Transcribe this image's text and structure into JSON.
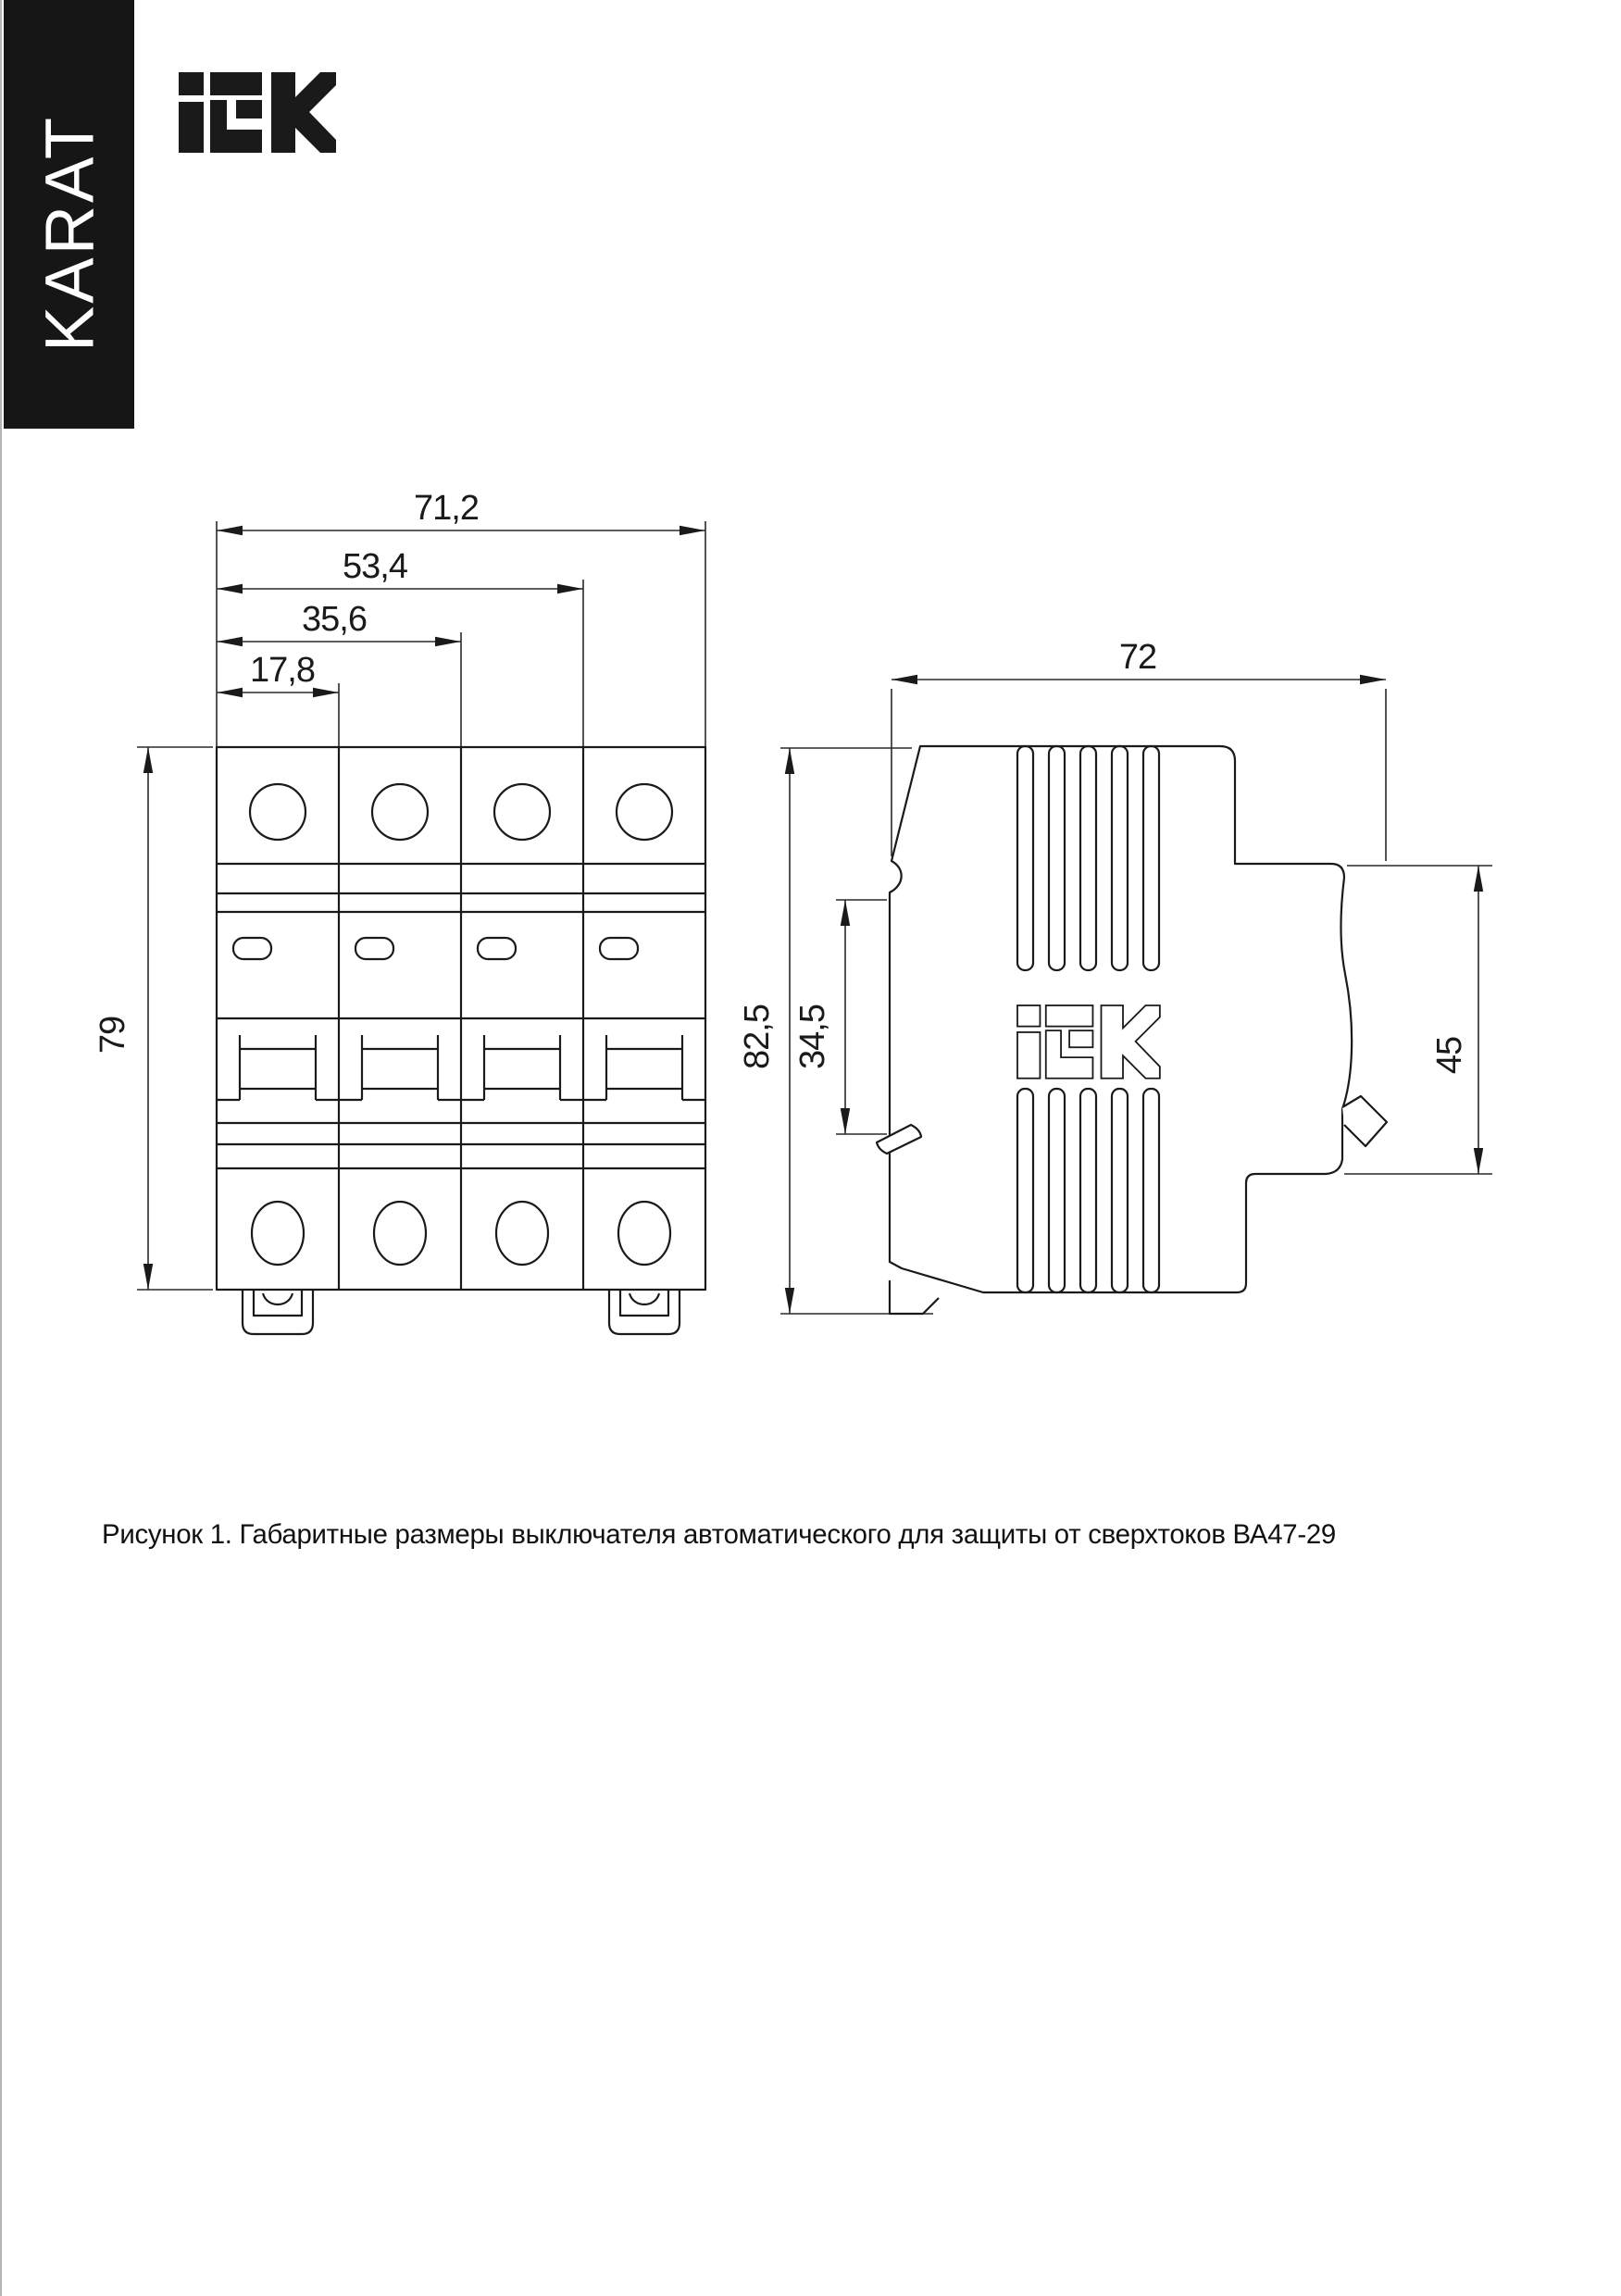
{
  "brand": {
    "banner_text": "KARAT",
    "logo_text": "IEK"
  },
  "figure": {
    "caption": "Рисунок 1. Габаритные размеры выключателя автоматического для защиты от сверхтоков ВА47-29"
  },
  "front_view": {
    "dimensions": {
      "total_width": "71,2",
      "three_modules": "53,4",
      "two_modules": "35,6",
      "one_module": "17,8",
      "height": "79"
    }
  },
  "side_view": {
    "dimensions": {
      "depth": "72",
      "height": "82,5",
      "front_plate": "34,5",
      "rail_section": "45"
    }
  },
  "colors": {
    "ink": "#1a1a1a",
    "banner_bg": "#161616",
    "banner_fg": "#ffffff",
    "page_bg": "#ffffff"
  }
}
